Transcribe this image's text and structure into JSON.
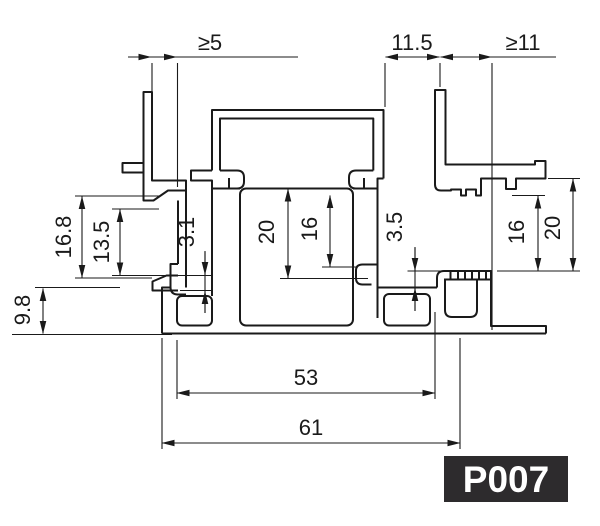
{
  "drawing": {
    "type": "Technical cross-section drawing of an aluminium glazing profile",
    "part_number": "P007",
    "background": "#ffffff",
    "line_color": "#1a1a1a",
    "badge": {
      "label": "P007",
      "bg": "#2d2b2d",
      "fg": "#ffffff"
    }
  },
  "dims": {
    "ge5": "≥5",
    "d115": "11.5",
    "ge11": "≥11",
    "d168": "16.8",
    "d135": "13.5",
    "d31": "3.1",
    "d98": "9.8",
    "c20": "20",
    "c16": "16",
    "r35": "3.5",
    "r16": "16",
    "r20": "20",
    "b53": "53",
    "b61": "61"
  },
  "dimensions": [
    {
      "label": "≥5",
      "region": "top-left gap",
      "orientation": "horizontal"
    },
    {
      "label": "11.5",
      "region": "top-middle gap",
      "orientation": "horizontal"
    },
    {
      "label": "≥11",
      "region": "top-right gap",
      "orientation": "horizontal"
    },
    {
      "label": "16.8",
      "region": "left channel height",
      "orientation": "vertical"
    },
    {
      "label": "13.5",
      "region": "left channel clear height",
      "orientation": "vertical"
    },
    {
      "label": "3.1",
      "region": "left hook lip height",
      "orientation": "vertical"
    },
    {
      "label": "9.8",
      "region": "base rail height",
      "orientation": "vertical"
    },
    {
      "label": "20",
      "region": "center channel height",
      "orientation": "vertical"
    },
    {
      "label": "16",
      "region": "center channel clear height",
      "orientation": "vertical"
    },
    {
      "label": "3.5",
      "region": "right step height",
      "orientation": "vertical"
    },
    {
      "label": "16",
      "region": "right pocket clear height",
      "orientation": "vertical"
    },
    {
      "label": "20",
      "region": "right pocket height",
      "orientation": "vertical"
    },
    {
      "label": "53",
      "region": "inner width",
      "orientation": "horizontal"
    },
    {
      "label": "61",
      "region": "overall width",
      "orientation": "horizontal"
    }
  ]
}
